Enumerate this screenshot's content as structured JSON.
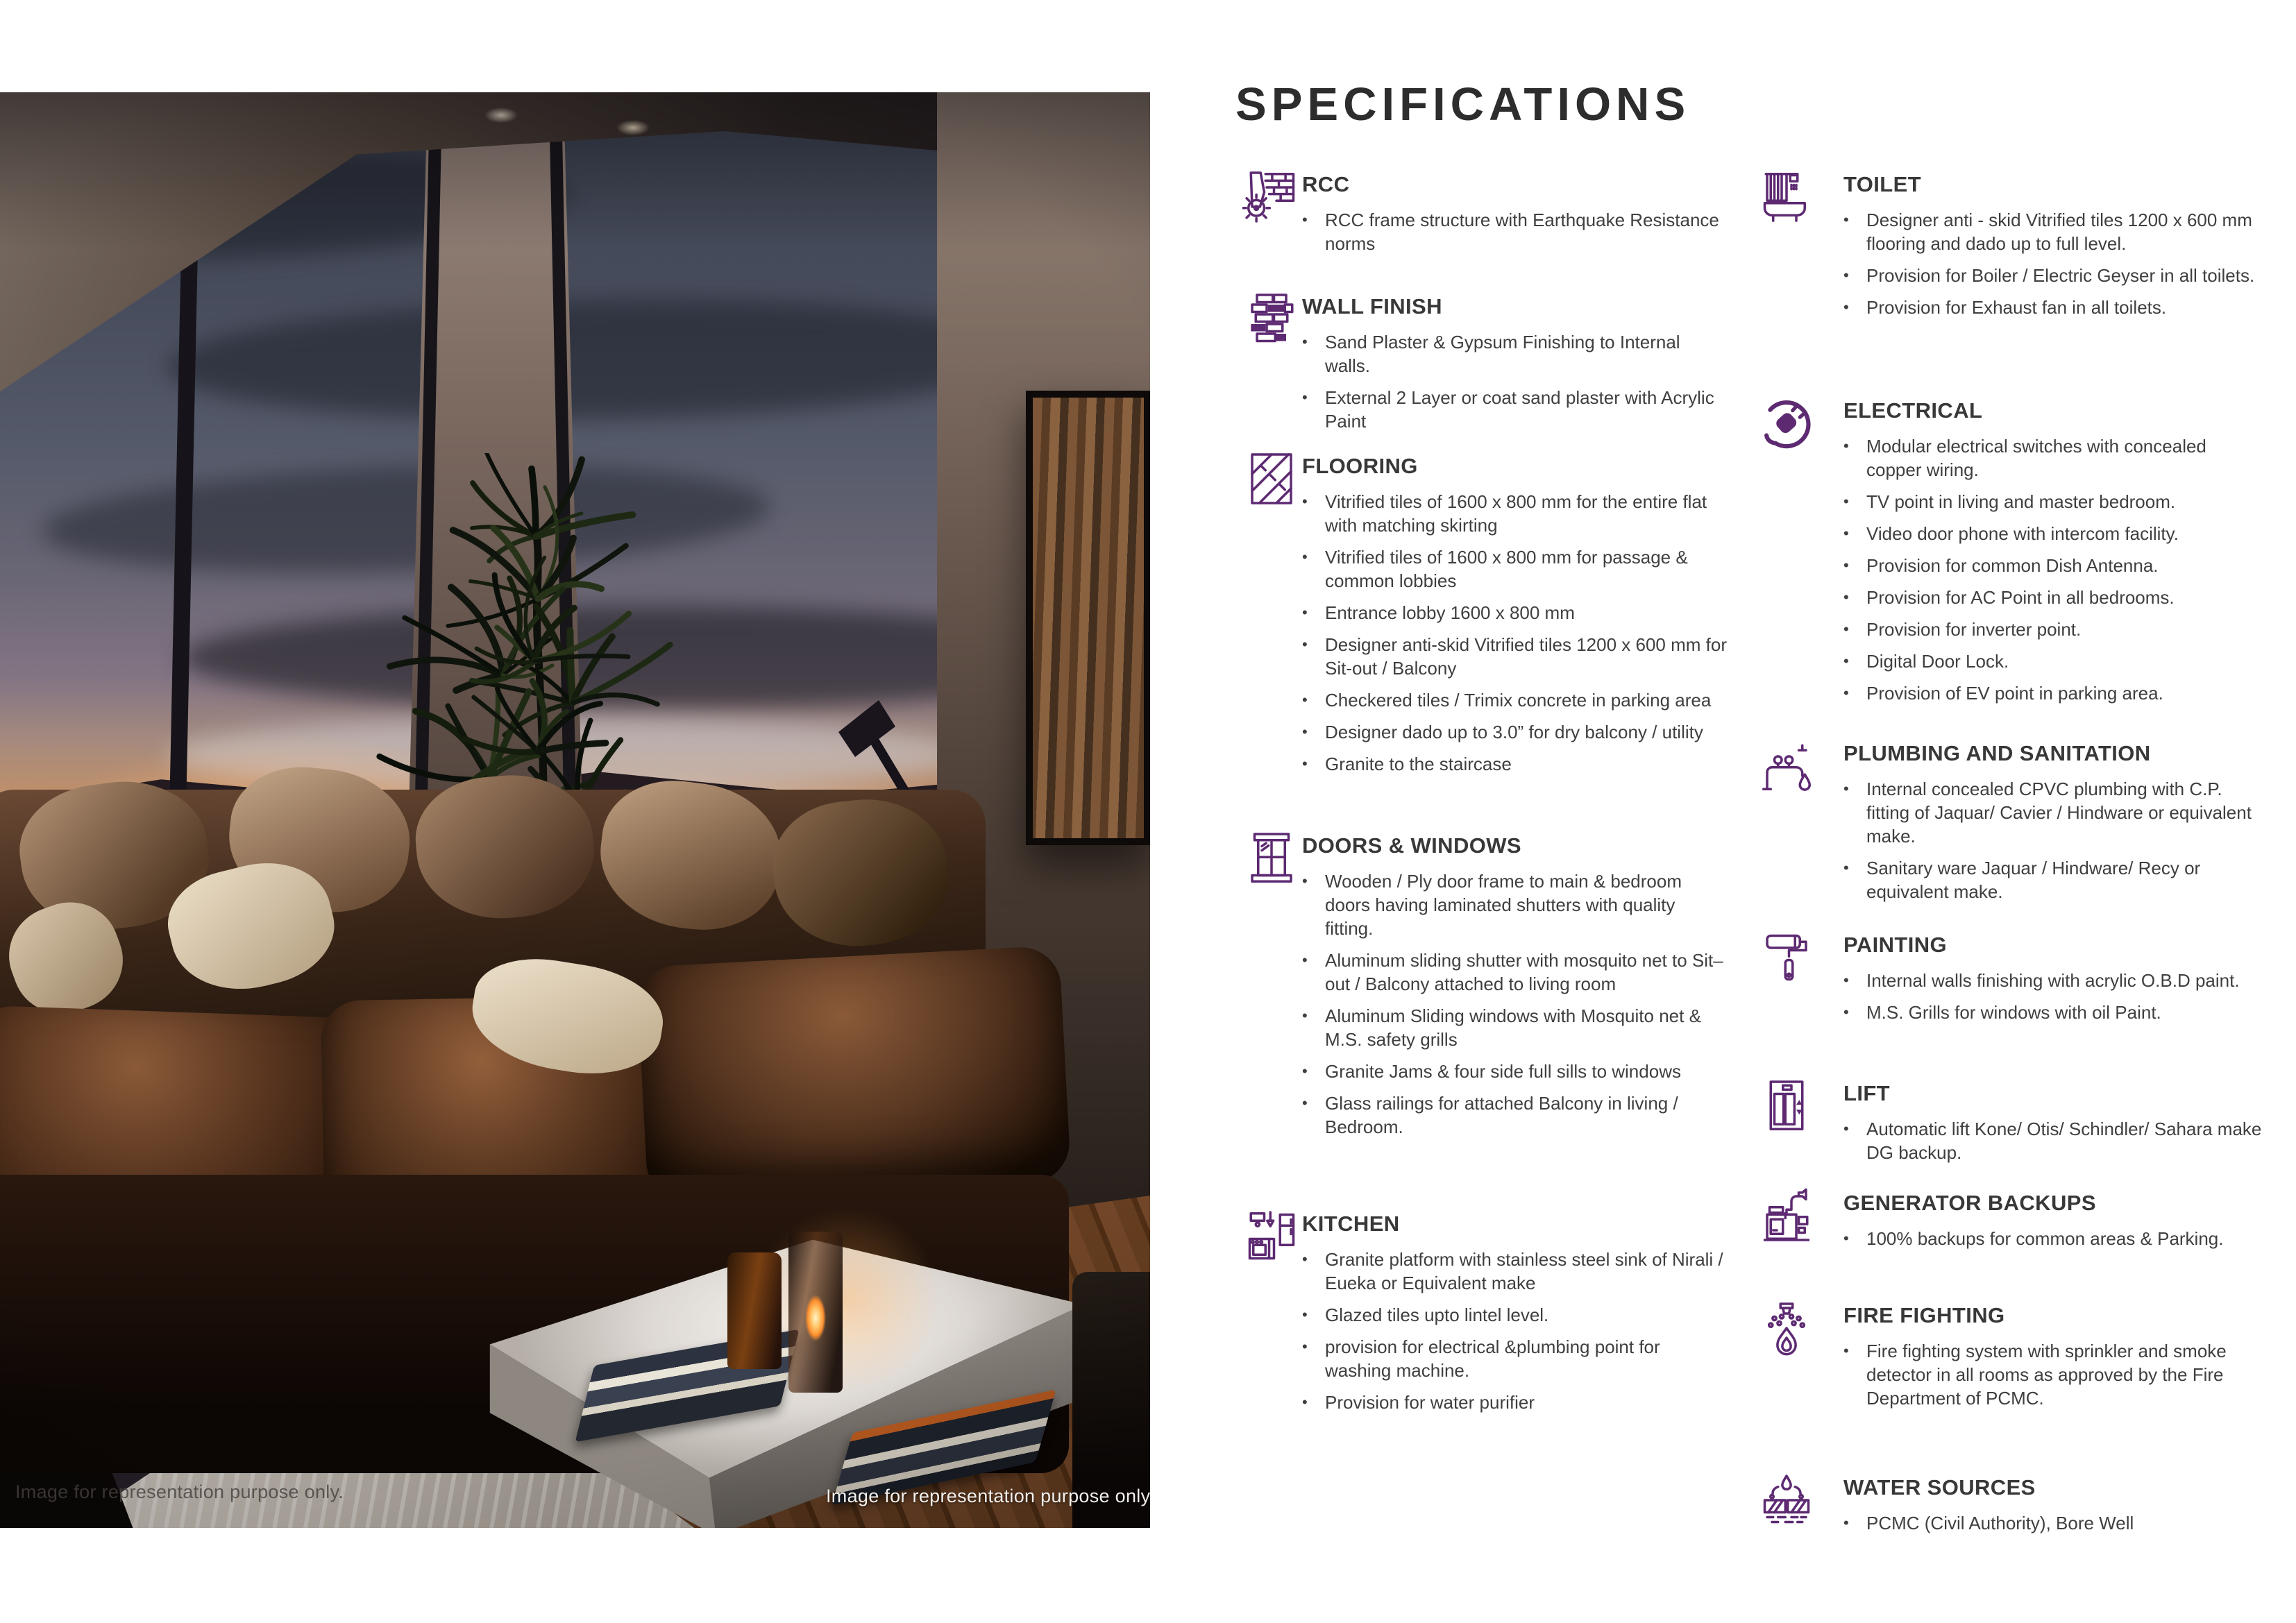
{
  "page": {
    "title": "SPECIFICATIONS"
  },
  "photo": {
    "caption_left": "Image for representation purpose only.",
    "caption_right": "Image for representation purpose only."
  },
  "colors": {
    "accent": "#5d2a72",
    "heading_text": "#383838",
    "body_text": "#3f3f3f",
    "title_text": "#2d2d2d"
  },
  "columns": [
    {
      "sections": [
        {
          "icon": "rcc-icon",
          "title": "RCC",
          "bullets": [
            "RCC frame structure with Earthquake Resistance norms"
          ]
        },
        {
          "icon": "wall-finish-icon",
          "title": "WALL FINISH",
          "bullets": [
            "Sand Plaster & Gypsum Finishing to Internal walls.",
            "External 2 Layer or coat sand plaster with Acrylic Paint"
          ]
        },
        {
          "icon": "flooring-icon",
          "title": "FLOORING",
          "bullets": [
            "Vitrified tiles of 1600 x 800 mm for the entire flat with matching skirting",
            "Vitrified tiles of 1600 x 800 mm for passage & common lobbies",
            "Entrance lobby 1600 x 800 mm",
            "Designer anti-skid Vitrified tiles 1200 x 600 mm for Sit-out / Balcony",
            "Checkered tiles / Trimix concrete in parking area",
            "Designer dado up to 3.0” for dry balcony / utility",
            "Granite to the staircase"
          ]
        },
        {
          "icon": "doors-windows-icon",
          "title": "DOORS &  WINDOWS",
          "bullets": [
            "Wooden / Ply door frame to main & bedroom doors having laminated shutters with quality fitting.",
            "Aluminum sliding shutter with mosquito net to Sit–out / Balcony attached to living room",
            "Aluminum Sliding windows with Mosquito net & M.S. safety grills",
            "Granite Jams & four side full sills to windows",
            "Glass railings for attached Balcony in living / Bedroom."
          ]
        },
        {
          "icon": "kitchen-icon",
          "title": "KITCHEN",
          "bullets": [
            "Granite platform with stainless steel sink of Nirali / Eueka or Equivalent make",
            "Glazed tiles upto lintel level.",
            "provision for electrical &plumbing point for washing machine.",
            "Provision for water purifier"
          ]
        }
      ]
    },
    {
      "sections": [
        {
          "icon": "toilet-icon",
          "title": "TOILET",
          "bullets": [
            "Designer anti -  skid Vitrified tiles 1200 x 600 mm flooring and dado up to full level.",
            "Provision for Boiler / Electric Geyser in all toilets.",
            "Provision for Exhaust fan in all toilets."
          ]
        },
        {
          "icon": "electrical-icon",
          "title": "ELECTRICAL",
          "bullets": [
            "Modular electrical switches with concealed copper wiring.",
            "TV point in living and master bedroom.",
            "Video door phone with intercom facility.",
            "Provision for common Dish Antenna.",
            "Provision for AC Point in all bedrooms.",
            "Provision for inverter point.",
            "Digital Door Lock.",
            "Provision of  EV point in parking area."
          ]
        },
        {
          "icon": "plumbing-icon",
          "title": "PLUMBING AND SANITATION",
          "bullets": [
            "Internal concealed CPVC plumbing with C.P. fitting of Jaquar/ Cavier / Hindware or equivalent make.",
            "Sanitary ware Jaquar / Hindware/ Recy or equivalent make."
          ]
        },
        {
          "icon": "painting-icon",
          "title": "PAINTING",
          "bullets": [
            "Internal walls finishing with acrylic O.B.D paint.",
            "M.S. Grills for windows with oil Paint."
          ]
        },
        {
          "icon": "lift-icon",
          "title": "LIFT",
          "bullets": [
            "Automatic lift Kone/ Otis/ Schindler/ Sahara make DG backup."
          ]
        },
        {
          "icon": "generator-icon",
          "title": "GENERATOR BACKUPS",
          "bullets": [
            "100% backups for common areas & Parking."
          ]
        },
        {
          "icon": "fire-fighting-icon",
          "title": "FIRE FIGHTING",
          "bullets": [
            "Fire fighting system with sprinkler and smoke detector in all rooms as approved by the Fire Department of PCMC."
          ]
        },
        {
          "icon": "water-sources-icon",
          "title": "WATER SOURCES",
          "bullets": [
            "PCMC (Civil Authority), Bore Well"
          ]
        }
      ]
    }
  ]
}
